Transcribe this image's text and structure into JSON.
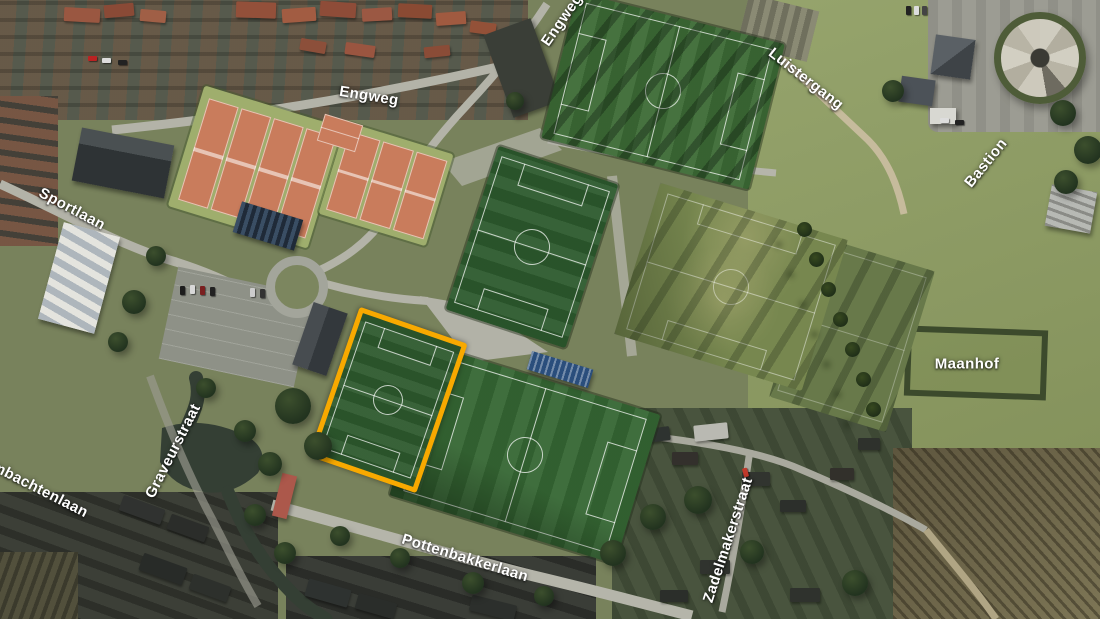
{
  "map": {
    "kind": "aerial-satellite-map",
    "highlight": {
      "name": "highlighted-football-field",
      "color": "#F8A900"
    },
    "labels": [
      {
        "id": "engweg",
        "text": "Engweg"
      },
      {
        "id": "engweg-top",
        "text": "Engweg"
      },
      {
        "id": "sportlaan",
        "text": "Sportlaan"
      },
      {
        "id": "luistergang",
        "text": "Luistergang"
      },
      {
        "id": "bastion",
        "text": "Bastion"
      },
      {
        "id": "maanhof",
        "text": "Maanhof"
      },
      {
        "id": "ambachtenlaan",
        "text": "Ambachtenlaan"
      },
      {
        "id": "graveurstraat",
        "text": "Graveurstraat"
      },
      {
        "id": "pottenbakkerlaan",
        "text": "Pottenbakkerlaan"
      },
      {
        "id": "zadelmakerstraat",
        "text": "Zadelmakerstraat"
      }
    ]
  }
}
